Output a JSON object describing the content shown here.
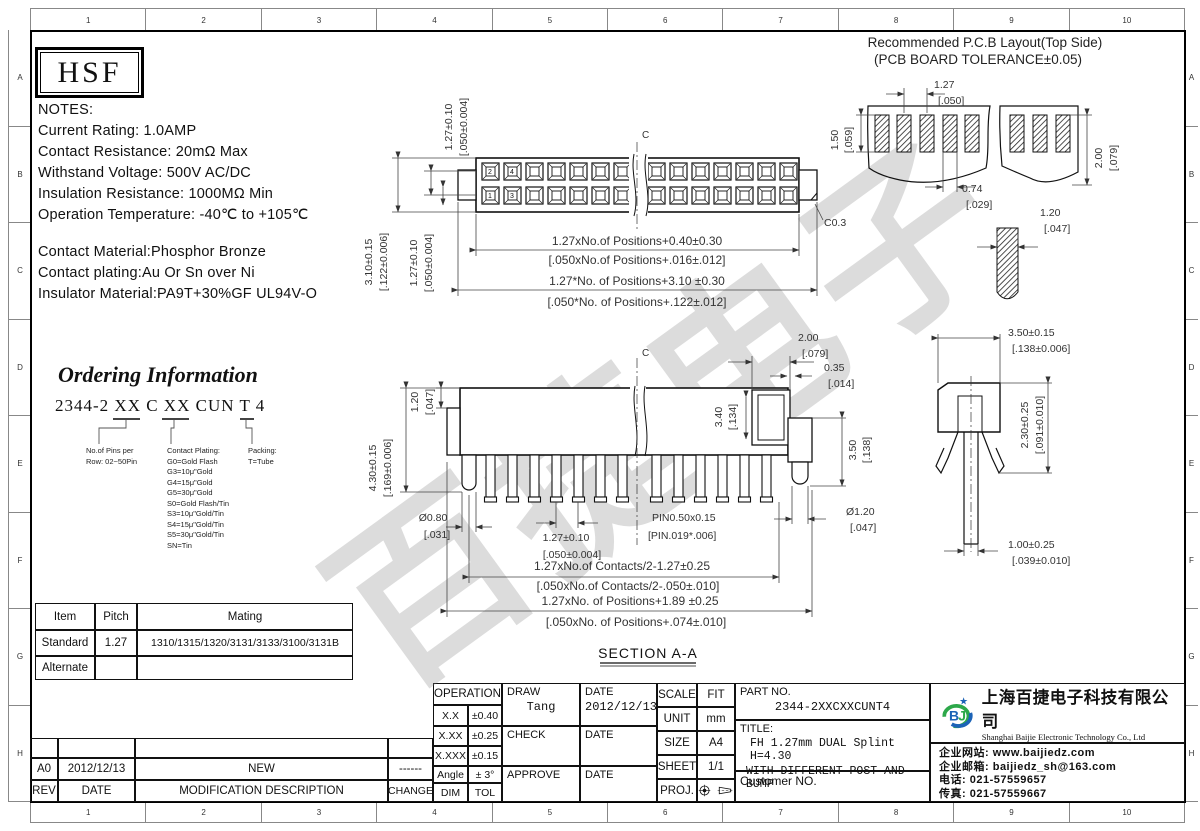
{
  "sheet": {
    "cols": [
      "1",
      "2",
      "3",
      "4",
      "5",
      "6",
      "7",
      "8",
      "9",
      "10"
    ],
    "rowsL": [
      "A",
      "B",
      "C",
      "D",
      "E",
      "F",
      "G",
      "H"
    ]
  },
  "brand": "HSF",
  "watermark": "百捷电子",
  "notes": {
    "heading": "NOTES:",
    "lines": [
      "Current Rating: 1.0AMP",
      "Contact Resistance: 20mΩ Max",
      "Withstand Voltage: 500V AC/DC",
      "Insulation Resistance: 1000MΩ Min",
      "Operation Temperature: -40℃ to +105℃"
    ],
    "materials": [
      "Contact Material:Phosphor Bronze",
      "Contact plating:Au Or Sn over Ni",
      "Insulator Material:PA9T+30%GF UL94V-O"
    ]
  },
  "ordering": {
    "title": "Ordering Information",
    "code": "2344-2 XX C XX CUN T 4",
    "pins": [
      "No.of Pins per",
      "Row: 02~50Pin"
    ],
    "plating_heading": "Contact Plating:",
    "plating": [
      "G0=Gold Flash",
      "G3=10μ\"Gold",
      "G4=15μ\"Gold",
      "G5=30μ\"Gold",
      "S0=Gold Flash/Tin",
      "S3=10μ\"Gold/Tin",
      "S4=15μ\"Gold/Tin",
      "S5=30μ\"Gold/Tin",
      "SN=Tin"
    ],
    "packing": [
      "Packing:",
      "T=Tube"
    ]
  },
  "mating": {
    "headers": [
      "Item",
      "Pitch",
      "Mating"
    ],
    "row1": [
      "Standard",
      "1.27",
      "1310/1315/1320/3131/3133/3100/3131B"
    ],
    "row2": [
      "Alternate",
      "",
      ""
    ]
  },
  "rev": {
    "row": [
      "A0",
      "2012/12/13",
      "NEW",
      "------"
    ],
    "headers": [
      "REV",
      "DATE",
      "MODIFICATION DESCRIPTION",
      "CHANGE"
    ]
  },
  "tb": {
    "op_label": "OPERATION",
    "tol": [
      [
        "X.X",
        "±0.40"
      ],
      [
        "X.XX",
        "±0.25"
      ],
      [
        "X.XXX",
        "±0.15"
      ],
      [
        "Angle",
        "± 3°"
      ],
      [
        "DIM",
        "TOL"
      ]
    ],
    "draw_label": "DRAW",
    "draw_name": "Tang",
    "date_label": "DATE",
    "draw_date": "2012/12/13",
    "check_label": "CHECK",
    "approve_label": "APPROVE",
    "scale": [
      "SCALE",
      "FIT"
    ],
    "unit": [
      "UNIT",
      "mm"
    ],
    "size": [
      "SIZE",
      "A4"
    ],
    "sheetno": [
      "SHEET",
      "1/1"
    ],
    "proj_label": "PROJ.",
    "part_label": "PART NO.",
    "part_no": "2344-2XXCXXCUNT4",
    "title_label": "TITLE:",
    "title1": "FH 1.27mm  DUAL Splint H=4.30",
    "title2": "WITH DIFFERENT POST AND BUMP",
    "customer_label": "Customer NO."
  },
  "co": {
    "logo": "BJ",
    "name_cn": "上海百捷电子科技有限公司",
    "name_en": "Shanghai Baijie Electronic Technology Co., Ltd",
    "lines": [
      "企业网站: www.baijiedz.com",
      "企业邮箱: baijiedz_sh@163.com",
      "电话: 021-57559657",
      "传真: 021-57559667"
    ]
  },
  "drw": {
    "cl": "C",
    "section_label": "SECTION A-A",
    "tv": {
      "rowpitch": [
        "1.27±0.10",
        "[.050±0.004]"
      ],
      "h": [
        "3.10±0.15",
        "[.122±0.006]"
      ],
      "rowpitch2": [
        "1.27±0.10",
        "[.050±0.004]"
      ],
      "len1": [
        "1.27xNo.of Positions+0.40±0.30",
        "[.050xNo.of Positions+.016±.012]"
      ],
      "len2": [
        "1.27*No. of Positions+3.10 ±0.30",
        "[.050*No. of Positions+.122±.012]"
      ],
      "chamfer": "C0.3",
      "pins": [
        "2",
        "4",
        "1",
        "3"
      ]
    },
    "pcb": {
      "title1": "Recommended P.C.B Layout(Top Side)",
      "title2": "(PCB BOARD TOLERANCE±0.05)",
      "pitch": [
        "1.27",
        "[.050]"
      ],
      "padh": [
        "1.50",
        "[.059]"
      ],
      "padw": [
        "0.74",
        "[.029]"
      ],
      "rowsp": [
        "2.00",
        "[.079]"
      ],
      "postw": [
        "1.20",
        "[.047]"
      ]
    },
    "sv": {
      "bump": [
        "1.20",
        "[.047]"
      ],
      "height": [
        "4.30±0.15",
        "[.169±0.006]"
      ],
      "post": [
        "Ø0.80",
        "[.031]"
      ],
      "pitch": [
        "1.27±0.10",
        "[.050±0.004]"
      ],
      "pin": [
        "PIN0.50x0.15",
        "[PIN.019*.006]"
      ],
      "slot": [
        "3.40",
        "[.134]"
      ],
      "postw": [
        "2.00",
        "[.079]"
      ],
      "gap": [
        "0.35",
        "[.014]"
      ],
      "step": [
        "3.50",
        "[.138]"
      ],
      "steppin": [
        "Ø1.20",
        "[.047]"
      ],
      "span1": [
        "1.27xNo.of Contacts/2-1.27±0.25",
        "[.050xNo.of Contacts/2-.050±.010]"
      ],
      "span2": [
        "1.27xNo. of Positions+1.89 ±0.25",
        "[.050xNo. of Positions+.074±.010]"
      ]
    },
    "sec": {
      "w": [
        "3.50±0.15",
        "[.138±0.006]"
      ],
      "h": [
        "2.30±0.25",
        "[.091±0.010]"
      ],
      "pin": [
        "1.00±0.25",
        "[.039±0.010]"
      ]
    }
  }
}
